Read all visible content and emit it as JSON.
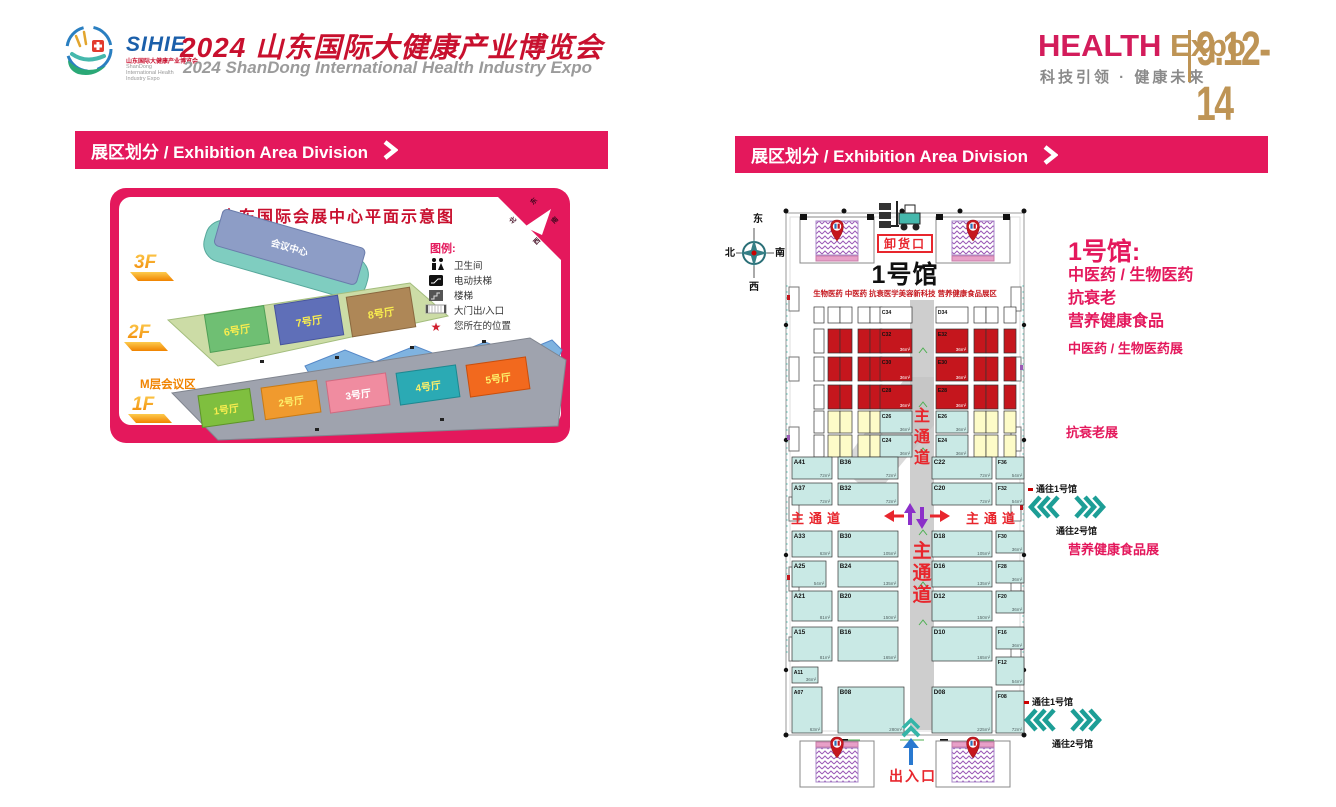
{
  "header": {
    "logo": {
      "acronym": "SIHIE",
      "cn": "山东国际大健康产业博览会",
      "en": "ShanDong International Health Industry Expo"
    },
    "title_cn": "2024 山东国际大健康产业博览会",
    "title_en": "2024 ShanDong International Health Industry Expo",
    "brand_health": "HEALTH",
    "brand_expo": "Expo",
    "slogan": "科技引领 · 健康未来",
    "dates": "9.12-14"
  },
  "left_panel": {
    "banner": "展区划分 / Exhibition Area Division",
    "map": {
      "title": "山东国际会展中心平面示意图",
      "floors": [
        "3F",
        "2F",
        "1F"
      ],
      "floor3_hall": "会议中心",
      "floor2_halls": [
        "6号厅",
        "7号厅",
        "8号厅"
      ],
      "mezzanine": "M层会议区",
      "floor1_halls": [
        "1号厅",
        "2号厅",
        "3号厅",
        "4号厅",
        "5号厅"
      ],
      "legend_title": "图例:",
      "legend": [
        "卫生间",
        "电动扶梯",
        "楼梯",
        "大门出/入口",
        "您所在的位置"
      ],
      "compass": {
        "n": "北",
        "e": "东",
        "s": "南",
        "w": "西"
      }
    }
  },
  "right_panel": {
    "banner": "展区划分 / Exhibition Area Division",
    "compass": {
      "n": "北",
      "e": "东",
      "s": "南",
      "w": "西"
    },
    "map": {
      "hall_title": "1号馆",
      "hall_subtitle": "生物医药 中医药 抗衰医学美容新科技 营养健康食品展区",
      "unloading": "卸货口",
      "entrance": "出入口",
      "aisle": "主通道",
      "booths": [
        [
          34,
          112,
          10,
          16,
          "w",
          null,
          null
        ],
        [
          48,
          112,
          24,
          16,
          "w",
          null,
          null,
          2
        ],
        [
          78,
          112,
          24,
          16,
          "w",
          null,
          null,
          2
        ],
        [
          100,
          112,
          32,
          16,
          "w",
          "C34",
          null
        ],
        [
          156,
          112,
          32,
          16,
          "w",
          "D34",
          null
        ],
        [
          194,
          112,
          24,
          16,
          "w",
          null,
          null,
          2
        ],
        [
          224,
          112,
          12,
          16,
          "w",
          null,
          null
        ],
        [
          34,
          134,
          10,
          24,
          "w",
          null,
          null
        ],
        [
          48,
          134,
          24,
          24,
          "r",
          null,
          null,
          2
        ],
        [
          78,
          134,
          24,
          24,
          "r",
          null,
          null,
          2
        ],
        [
          100,
          134,
          32,
          24,
          "r",
          "C32",
          "36m²"
        ],
        [
          156,
          134,
          32,
          24,
          "r",
          "E32",
          "36m²"
        ],
        [
          194,
          134,
          24,
          24,
          "r",
          null,
          null,
          2
        ],
        [
          224,
          134,
          12,
          24,
          "r",
          null,
          null
        ],
        [
          34,
          162,
          10,
          24,
          "w",
          null,
          null
        ],
        [
          48,
          162,
          24,
          24,
          "r",
          null,
          null,
          2
        ],
        [
          78,
          162,
          24,
          24,
          "r",
          null,
          null,
          2
        ],
        [
          100,
          162,
          32,
          24,
          "r",
          "C30",
          "36m²"
        ],
        [
          156,
          162,
          32,
          24,
          "r",
          "E30",
          "36m²"
        ],
        [
          194,
          162,
          24,
          24,
          "r",
          null,
          null,
          2
        ],
        [
          224,
          162,
          12,
          24,
          "r",
          null,
          null
        ],
        [
          34,
          190,
          10,
          24,
          "w",
          null,
          null
        ],
        [
          48,
          190,
          24,
          24,
          "r",
          null,
          null,
          2
        ],
        [
          78,
          190,
          24,
          24,
          "r",
          null,
          null,
          2
        ],
        [
          100,
          190,
          32,
          24,
          "r",
          "C28",
          "36m²"
        ],
        [
          156,
          190,
          32,
          24,
          "r",
          "E28",
          "36m²"
        ],
        [
          194,
          190,
          24,
          24,
          "r",
          null,
          null,
          2
        ],
        [
          224,
          190,
          12,
          24,
          "r",
          null,
          null
        ],
        [
          34,
          216,
          10,
          22,
          "w",
          null,
          null
        ],
        [
          48,
          216,
          24,
          22,
          "y",
          null,
          null,
          2
        ],
        [
          78,
          216,
          24,
          22,
          "y",
          null,
          null,
          2
        ],
        [
          100,
          216,
          32,
          22,
          "t",
          "C26",
          "36m²"
        ],
        [
          156,
          216,
          32,
          22,
          "t",
          "E26",
          "36m²"
        ],
        [
          194,
          216,
          24,
          22,
          "y",
          null,
          null,
          2
        ],
        [
          224,
          216,
          12,
          22,
          "y",
          null,
          null
        ],
        [
          34,
          240,
          10,
          22,
          "w",
          null,
          null
        ],
        [
          48,
          240,
          24,
          22,
          "y",
          null,
          null,
          2
        ],
        [
          78,
          240,
          24,
          22,
          "y",
          null,
          null,
          2
        ],
        [
          100,
          240,
          32,
          22,
          "t",
          "C24",
          "36m²"
        ],
        [
          156,
          240,
          32,
          22,
          "t",
          "E24",
          "36m²"
        ],
        [
          194,
          240,
          24,
          22,
          "y",
          null,
          null,
          2
        ],
        [
          224,
          240,
          12,
          22,
          "y",
          null,
          null
        ],
        [
          12,
          262,
          40,
          22,
          "t",
          "A41",
          "72m²"
        ],
        [
          58,
          262,
          60,
          22,
          "t",
          "B36",
          "72m²"
        ],
        [
          152,
          262,
          60,
          22,
          "t",
          "C22",
          "72m²"
        ],
        [
          216,
          262,
          28,
          22,
          "t",
          "F36",
          "54m²"
        ],
        [
          12,
          288,
          40,
          22,
          "t",
          "A37",
          "72m²"
        ],
        [
          58,
          288,
          60,
          22,
          "t",
          "B32",
          "72m²"
        ],
        [
          152,
          288,
          60,
          22,
          "t",
          "C20",
          "72m²"
        ],
        [
          216,
          288,
          28,
          22,
          "t",
          "F32",
          "54m²"
        ],
        [
          12,
          336,
          40,
          26,
          "t",
          "A33",
          "63m²"
        ],
        [
          58,
          336,
          60,
          26,
          "t",
          "B30",
          "105m²"
        ],
        [
          152,
          336,
          60,
          26,
          "t",
          "D18",
          "105m²"
        ],
        [
          216,
          336,
          28,
          22,
          "t",
          "F30",
          "36m²"
        ],
        [
          12,
          366,
          34,
          26,
          "t",
          "A25",
          "54m²"
        ],
        [
          58,
          366,
          60,
          26,
          "t",
          "B24",
          "135m²"
        ],
        [
          152,
          366,
          60,
          26,
          "t",
          "D16",
          "135m²"
        ],
        [
          216,
          366,
          28,
          22,
          "t",
          "F28",
          "36m²"
        ],
        [
          12,
          396,
          40,
          30,
          "t",
          "A21",
          "81m²"
        ],
        [
          58,
          396,
          60,
          30,
          "t",
          "B20",
          "150m²"
        ],
        [
          152,
          396,
          60,
          30,
          "t",
          "D12",
          "150m²"
        ],
        [
          216,
          396,
          28,
          22,
          "t",
          "F20",
          "36m²"
        ],
        [
          12,
          432,
          40,
          34,
          "t",
          "A15",
          "81m²"
        ],
        [
          58,
          432,
          60,
          34,
          "t",
          "B16",
          "165m²"
        ],
        [
          152,
          432,
          60,
          34,
          "t",
          "D10",
          "165m²"
        ],
        [
          216,
          432,
          28,
          22,
          "t",
          "F16",
          "36m²"
        ],
        [
          12,
          472,
          26,
          16,
          "t",
          "A11",
          "36m²"
        ],
        [
          216,
          462,
          28,
          28,
          "t",
          "F12",
          "54m²"
        ],
        [
          12,
          492,
          30,
          46,
          "t",
          "A07",
          "63m²"
        ],
        [
          58,
          492,
          66,
          46,
          "t",
          "B08",
          "280m²"
        ],
        [
          152,
          492,
          60,
          46,
          "t",
          "D08",
          "225m²"
        ],
        [
          216,
          496,
          28,
          42,
          "t",
          "F08",
          "72m²"
        ]
      ]
    },
    "sidebar": {
      "hall_title": "1号馆:",
      "categories": [
        "中医药 / 生物医药",
        "抗衰老",
        "营养健康食品"
      ],
      "zone1": "中医药 / 生物医药展",
      "zone2": "抗衰老展",
      "zone3": "营养健康食品展"
    },
    "passages": {
      "to1": "通往1号馆",
      "to2": "通往2号馆"
    }
  }
}
